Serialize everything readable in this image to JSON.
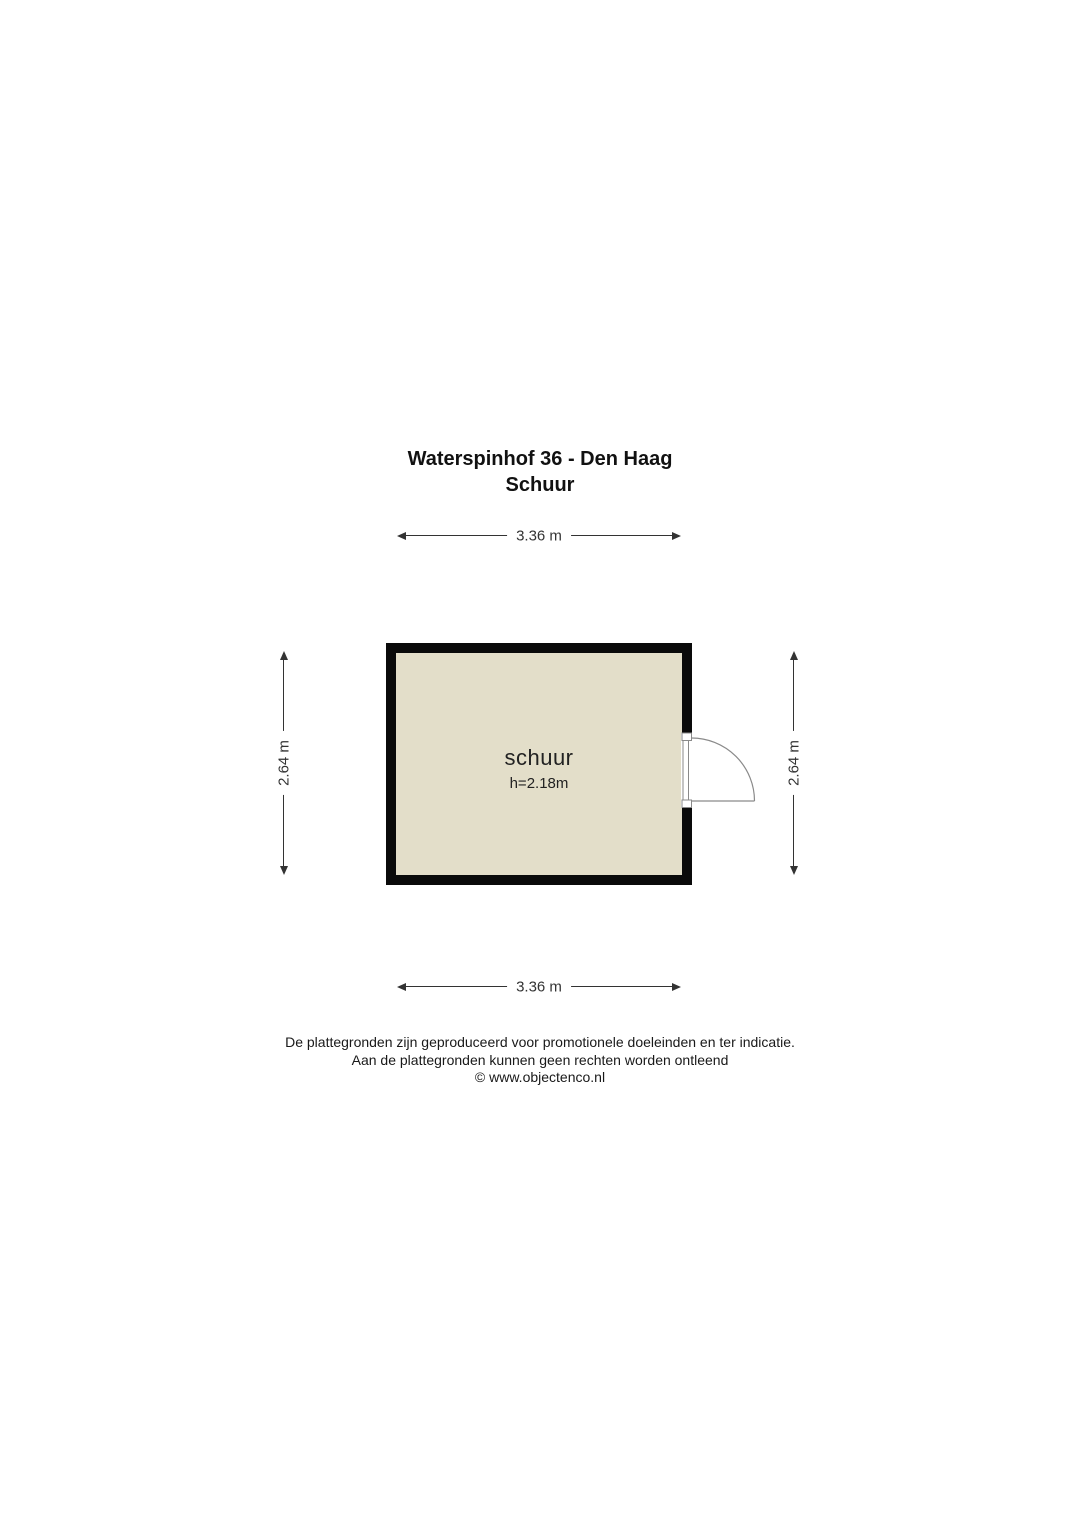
{
  "title": {
    "line1": "Waterspinhof 36 - Den Haag",
    "line2": "Schuur"
  },
  "dimensions": {
    "top": "3.36 m",
    "bottom": "3.36 m",
    "left": "2.64 m",
    "right": "2.64 m"
  },
  "room": {
    "name": "schuur",
    "height": "h=2.18m"
  },
  "footer": {
    "line1": "De plattegronden zijn geproduceerd voor promotionele doeleinden en ter indicatie.",
    "line2": "Aan de plattegronden kunnen geen rechten worden ontleend",
    "line3": "© www.objectenco.nl"
  },
  "colors": {
    "floor_fill": "#e3dec9",
    "wall": "#0a0a0a",
    "door_stroke": "#8a8a8a",
    "dim_color": "#333333"
  }
}
